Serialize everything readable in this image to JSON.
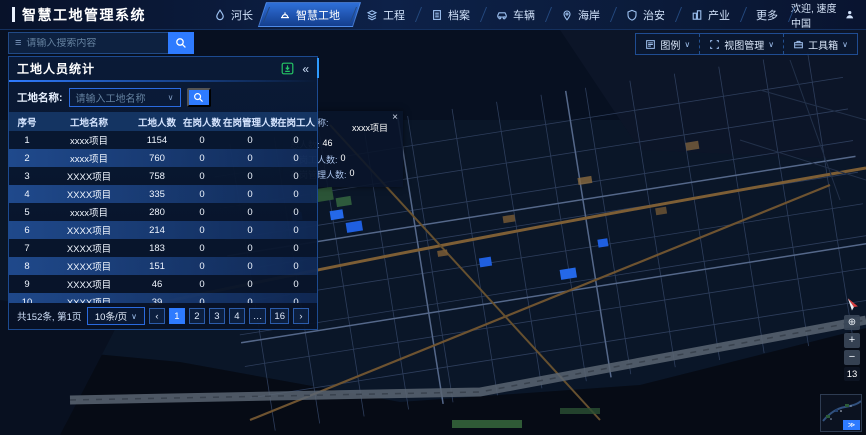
{
  "app": {
    "brand": "智慧工地管理系统",
    "welcome": "欢迎, 速度中国"
  },
  "nav": {
    "items": [
      {
        "label": "河长"
      },
      {
        "label": "智慧工地"
      },
      {
        "label": "工程"
      },
      {
        "label": "档案"
      },
      {
        "label": "车辆"
      },
      {
        "label": "海岸"
      },
      {
        "label": "治安"
      },
      {
        "label": "产业"
      },
      {
        "label": "更多"
      }
    ]
  },
  "search": {
    "placeholder": "请输入搜索内容"
  },
  "map_toolbar": {
    "legend": "图例",
    "view": "视图管理",
    "toolbox": "工具箱",
    "chevron": "∨"
  },
  "panel": {
    "title": "工地人员统计",
    "collapse_glyph": "«",
    "filter": {
      "label": "工地名称:",
      "placeholder": "请输入工地名称",
      "chevron": "∨"
    },
    "table": {
      "headers": [
        "序号",
        "工地名称",
        "工地人数",
        "在岗人数",
        "在岗管理人数",
        "在岗工人数"
      ],
      "rows": [
        {
          "no": "1",
          "name": "xxxx项目",
          "total": "1154",
          "onduty": "0",
          "mgmt": "0",
          "workers": "0"
        },
        {
          "no": "2",
          "name": "xxxx项目",
          "total": "760",
          "onduty": "0",
          "mgmt": "0",
          "workers": "0"
        },
        {
          "no": "3",
          "name": "XXXX项目",
          "total": "758",
          "onduty": "0",
          "mgmt": "0",
          "workers": "0"
        },
        {
          "no": "4",
          "name": "XXXX项目",
          "total": "335",
          "onduty": "0",
          "mgmt": "0",
          "workers": "0"
        },
        {
          "no": "5",
          "name": "xxxx项目",
          "total": "280",
          "onduty": "0",
          "mgmt": "0",
          "workers": "0"
        },
        {
          "no": "6",
          "name": "XXXX项目",
          "total": "214",
          "onduty": "0",
          "mgmt": "0",
          "workers": "0"
        },
        {
          "no": "7",
          "name": "XXXX项目",
          "total": "183",
          "onduty": "0",
          "mgmt": "0",
          "workers": "0"
        },
        {
          "no": "8",
          "name": "XXXX项目",
          "total": "151",
          "onduty": "0",
          "mgmt": "0",
          "workers": "0"
        },
        {
          "no": "9",
          "name": "XXXX项目",
          "total": "46",
          "onduty": "0",
          "mgmt": "0",
          "workers": "0"
        },
        {
          "no": "10",
          "name": "XXXX项目",
          "total": "39",
          "onduty": "0",
          "mgmt": "0",
          "workers": "0"
        }
      ]
    },
    "pagination": {
      "summary": "共152条, 第1页",
      "page_size": "10条/页",
      "chevron": "∨",
      "prev": "‹",
      "next": "›",
      "pages": [
        "1",
        "2",
        "3",
        "4",
        "…",
        "16"
      ]
    }
  },
  "popup": {
    "close": "×",
    "name_label": "项目名称:",
    "name_value": "xxxx项目",
    "total_label": "总人数:",
    "total_value": "46",
    "workers_label": "在岗工人数:",
    "workers_value": "0",
    "mgmt_label": "在岗管理人数:",
    "mgmt_value": "0"
  },
  "map_controls": {
    "locate": "⊕",
    "zoom_in": "+",
    "zoom_out": "−",
    "zoom_level": "13",
    "minimap_expand": "≫"
  },
  "colors": {
    "accent_blue": "#2e7bff",
    "nav_active": "#2e6fd8",
    "download_green": "#25c465",
    "row_highlight": "#24549f",
    "road_tan": "#7d5e35",
    "map_bg": "#0a1628"
  }
}
